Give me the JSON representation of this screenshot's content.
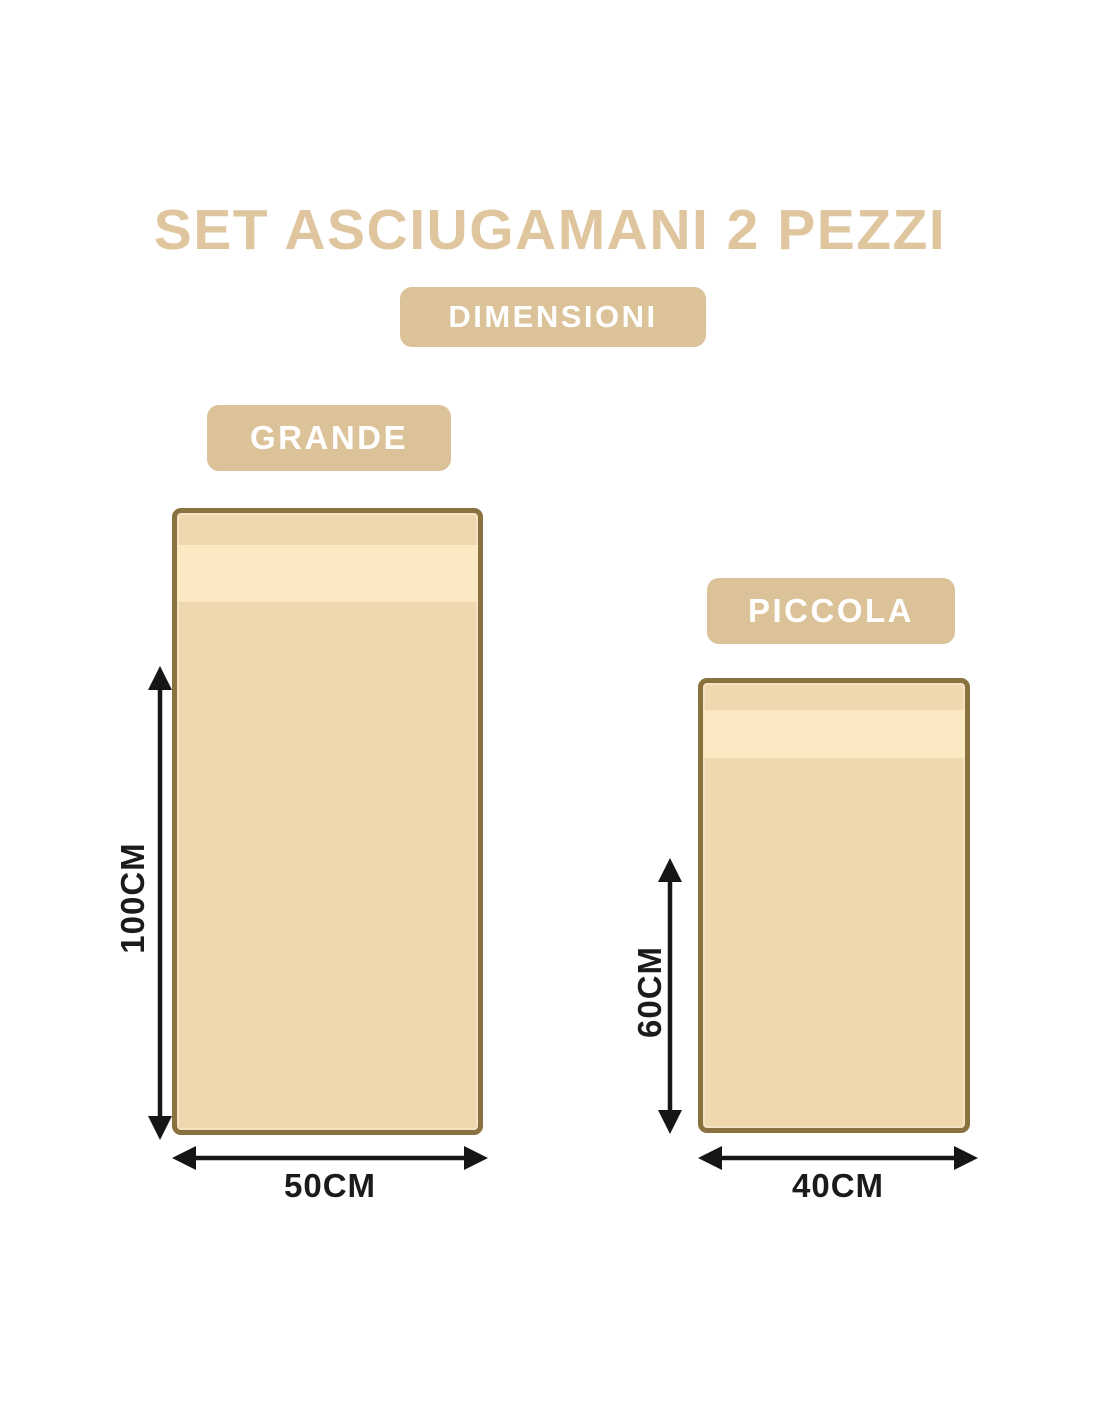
{
  "page": {
    "title": "SET ASCIUGAMANI 2 PEZZI",
    "dimensions_badge": "DIMENSIONI"
  },
  "towels": [
    {
      "name": "GRANDE",
      "height_label": "100CM",
      "width_label": "50CM",
      "height_cm": 100,
      "width_cm": 50
    },
    {
      "name": "PICCOLA",
      "height_label": "60CM",
      "width_label": "40CM",
      "height_cm": 60,
      "width_cm": 40
    }
  ],
  "colors": {
    "accent": "#dcc298",
    "title": "#dfc69e",
    "badge-text": "#ffffff",
    "towel-fill": "#efd8ad",
    "towel-stripe": "#fbe9c4",
    "towel-border": "#8a7140",
    "arrow": "#161616",
    "label": "#1b1b1b"
  }
}
